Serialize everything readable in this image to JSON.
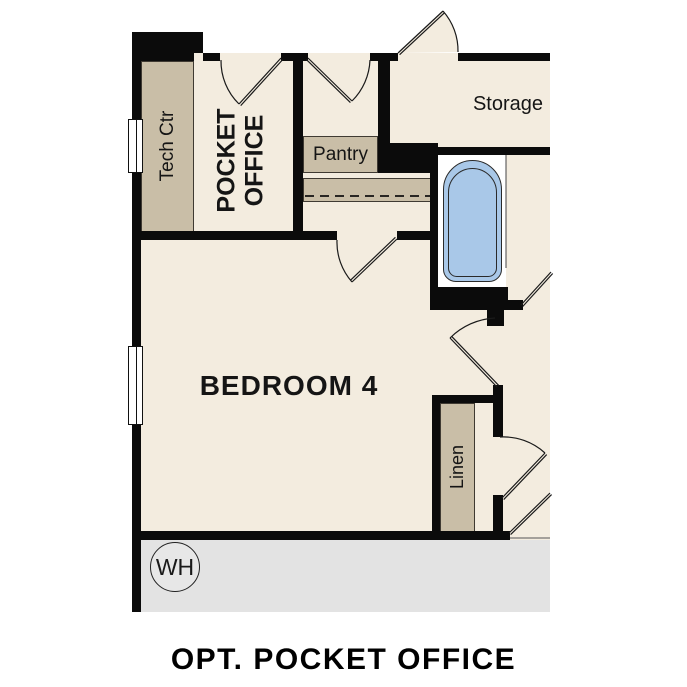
{
  "caption": "OPT. POCKET OFFICE",
  "labels": {
    "tech_ctr": "Tech Ctr",
    "pocket_office_line1": "POCKET",
    "pocket_office_line2": "OFFICE",
    "pantry": "Pantry",
    "storage": "Storage",
    "bedroom": "BEDROOM 4",
    "linen": "Linen",
    "water_heater": "WH"
  },
  "colors": {
    "floor": "#f3ecdf",
    "cabinet": "#c9bea7",
    "wall": "#0b0b0b",
    "bathtub": "#a9c8e8",
    "garage_floor": "#e3e3e3",
    "background": "#ffffff"
  }
}
